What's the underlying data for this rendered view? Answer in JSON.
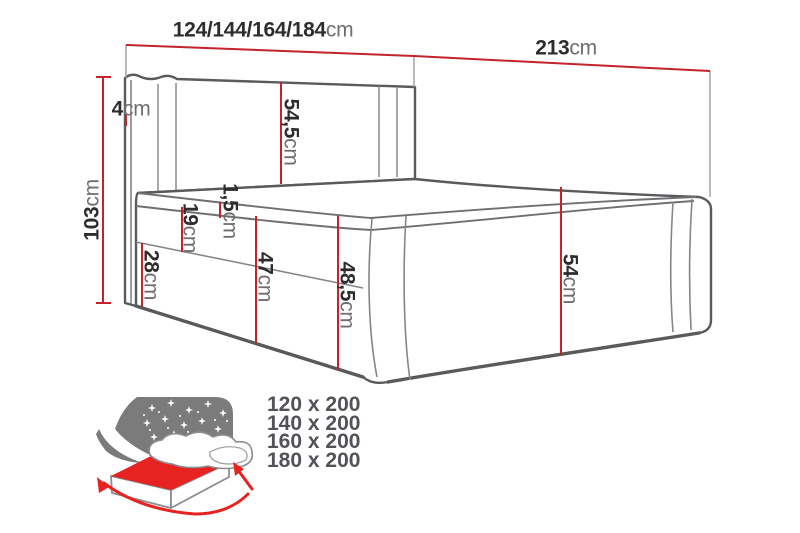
{
  "diagram": {
    "title": "boxspring-bed-dimension-diagram",
    "dimensions": {
      "width": {
        "value": "124/144/164/184",
        "unit": "cm"
      },
      "length": {
        "value": "213",
        "unit": "cm"
      },
      "height": {
        "value": "103",
        "unit": "cm"
      },
      "side_wing": {
        "value": "4",
        "unit": "cm"
      },
      "headboard": {
        "value": "54,5",
        "unit": "cm"
      },
      "piping": {
        "value": "1,5",
        "unit": "cm"
      },
      "mattress": {
        "value": "19",
        "unit": "cm"
      },
      "base": {
        "value": "28",
        "unit": "cm"
      },
      "side_total": {
        "value": "47",
        "unit": "cm"
      },
      "foot_corner": {
        "value": "48,5",
        "unit": "cm"
      },
      "footboard": {
        "value": "54",
        "unit": "cm"
      }
    },
    "available_sizes": [
      "120 x 200",
      "140 x 200",
      "160 x 200",
      "180 x 200"
    ],
    "colors": {
      "dimension_red": "#c4232b",
      "outline_gray": "#595a5c",
      "icon_red": "#e62320",
      "icon_gray": "#7b7b7b"
    }
  }
}
